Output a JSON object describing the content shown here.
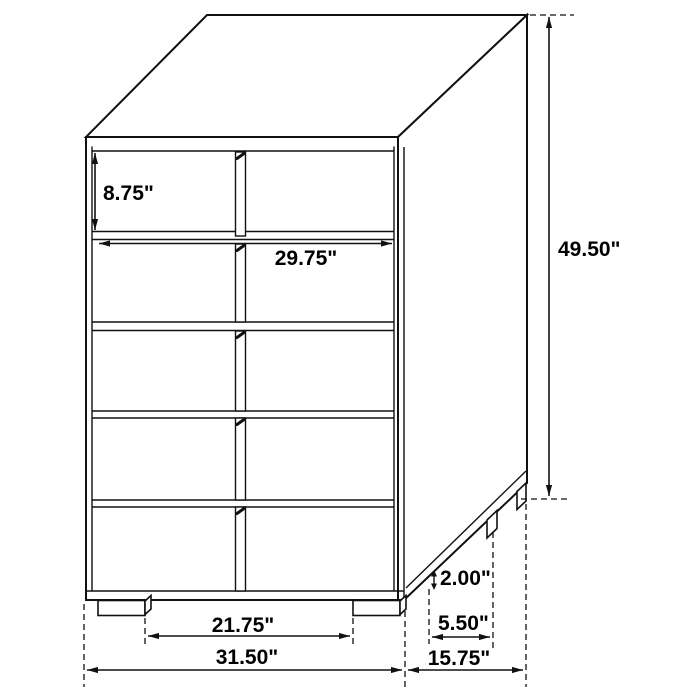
{
  "diagram": {
    "background_color": "#ffffff",
    "line_color": "#111111",
    "furniture": {
      "type": "chest-of-drawers",
      "drawer_rows": 5,
      "drawer_columns": 2
    },
    "dimensions": {
      "overall_height": "49.50\"",
      "overall_width": "31.50\"",
      "overall_depth": "15.75\"",
      "top_drawer_height": "8.75\"",
      "drawer_width": "29.75\"",
      "leg_height": "2.00\"",
      "side_leg_spacing": "5.50\"",
      "front_leg_spacing": "21.75\""
    }
  }
}
